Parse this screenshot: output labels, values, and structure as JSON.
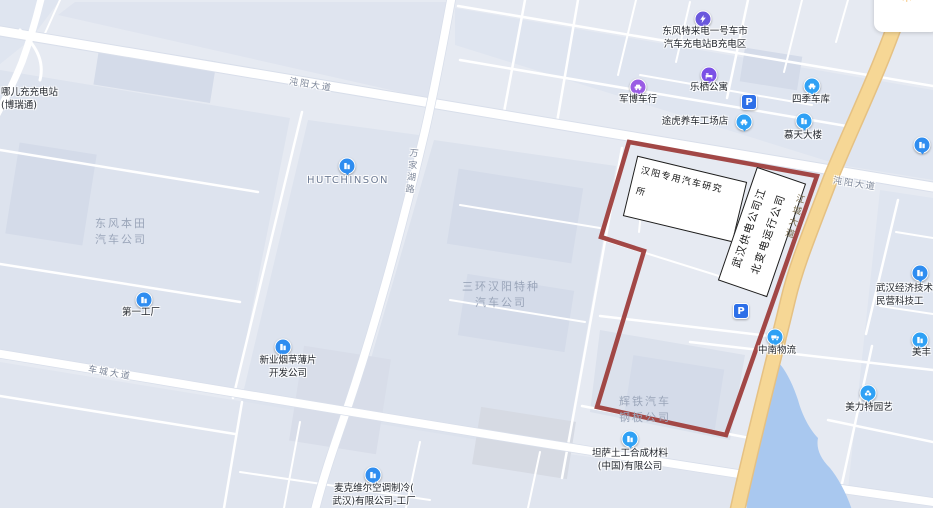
{
  "map": {
    "colors": {
      "background": "#e6eaf2",
      "block": "#dde3ee",
      "building": "#d4dbe9",
      "road": "#ffffff",
      "highway": "#f6d795",
      "water": "#a9c8ef",
      "parcel_outline": "#9e3e3c",
      "poi_blue": "#2fa1f5",
      "poi_indigo": "#6a58dd",
      "poi_purple": "#8e5ce6"
    },
    "symbols": {
      "parking": "P",
      "sun": "☀"
    },
    "parcel": {
      "box_a": {
        "lines": [
          "汉阳专用汽车研究",
          "所"
        ]
      },
      "box_b": {
        "lines": [
          "武汉供电公司江",
          "北变电运行公司"
        ]
      }
    },
    "road_labels": {
      "zhuanyang_w": "沌阳大道",
      "zhuanyang_e": "沌阳大道",
      "wanjiahu": "万家湖路",
      "jiangcheng": "江城大道",
      "checheng": "车城大道"
    },
    "area_labels": {
      "honda": {
        "lines": [
          "东风本田",
          "汽车公司"
        ]
      },
      "sanhuan": {
        "lines": [
          "三环汉阳特种",
          "汽车公司"
        ]
      },
      "huitie": {
        "lines": [
          "辉铁汽车",
          "钢板公司"
        ]
      }
    },
    "pois": {
      "nar": {
        "lines": [
          "哪儿充充电站",
          "(博瑞通)"
        ]
      },
      "telaidian": {
        "lines": [
          "东风特来电一号车市",
          "汽车充电站B充电区"
        ]
      },
      "junbo": {
        "label": "军博车行"
      },
      "lexi": {
        "label": "乐栖公寓"
      },
      "siji": {
        "label": "四季车库"
      },
      "tuhu": {
        "label": "途虎养车工场店"
      },
      "mutian": {
        "label": "慕天大楼"
      },
      "hutchinson": {
        "label": "HUTCHINSON"
      },
      "diyi": {
        "label": "第一工厂"
      },
      "xinye": {
        "lines": [
          "新业烟草薄片",
          "开发公司"
        ]
      },
      "tansa": {
        "lines": [
          "坦萨土工合成材料",
          "(中国)有限公司"
        ]
      },
      "maikeweier": {
        "lines": [
          "麦克维尔空调制冷(",
          "武汉)有限公司-工厂"
        ]
      },
      "zhongnan": {
        "label": "中南物流"
      },
      "whkfq": {
        "lines": [
          "武汉经济技术开",
          "民营科技工"
        ]
      },
      "meifeng": {
        "label": "美丰"
      },
      "meilite": {
        "label": "美力特园艺"
      }
    }
  }
}
